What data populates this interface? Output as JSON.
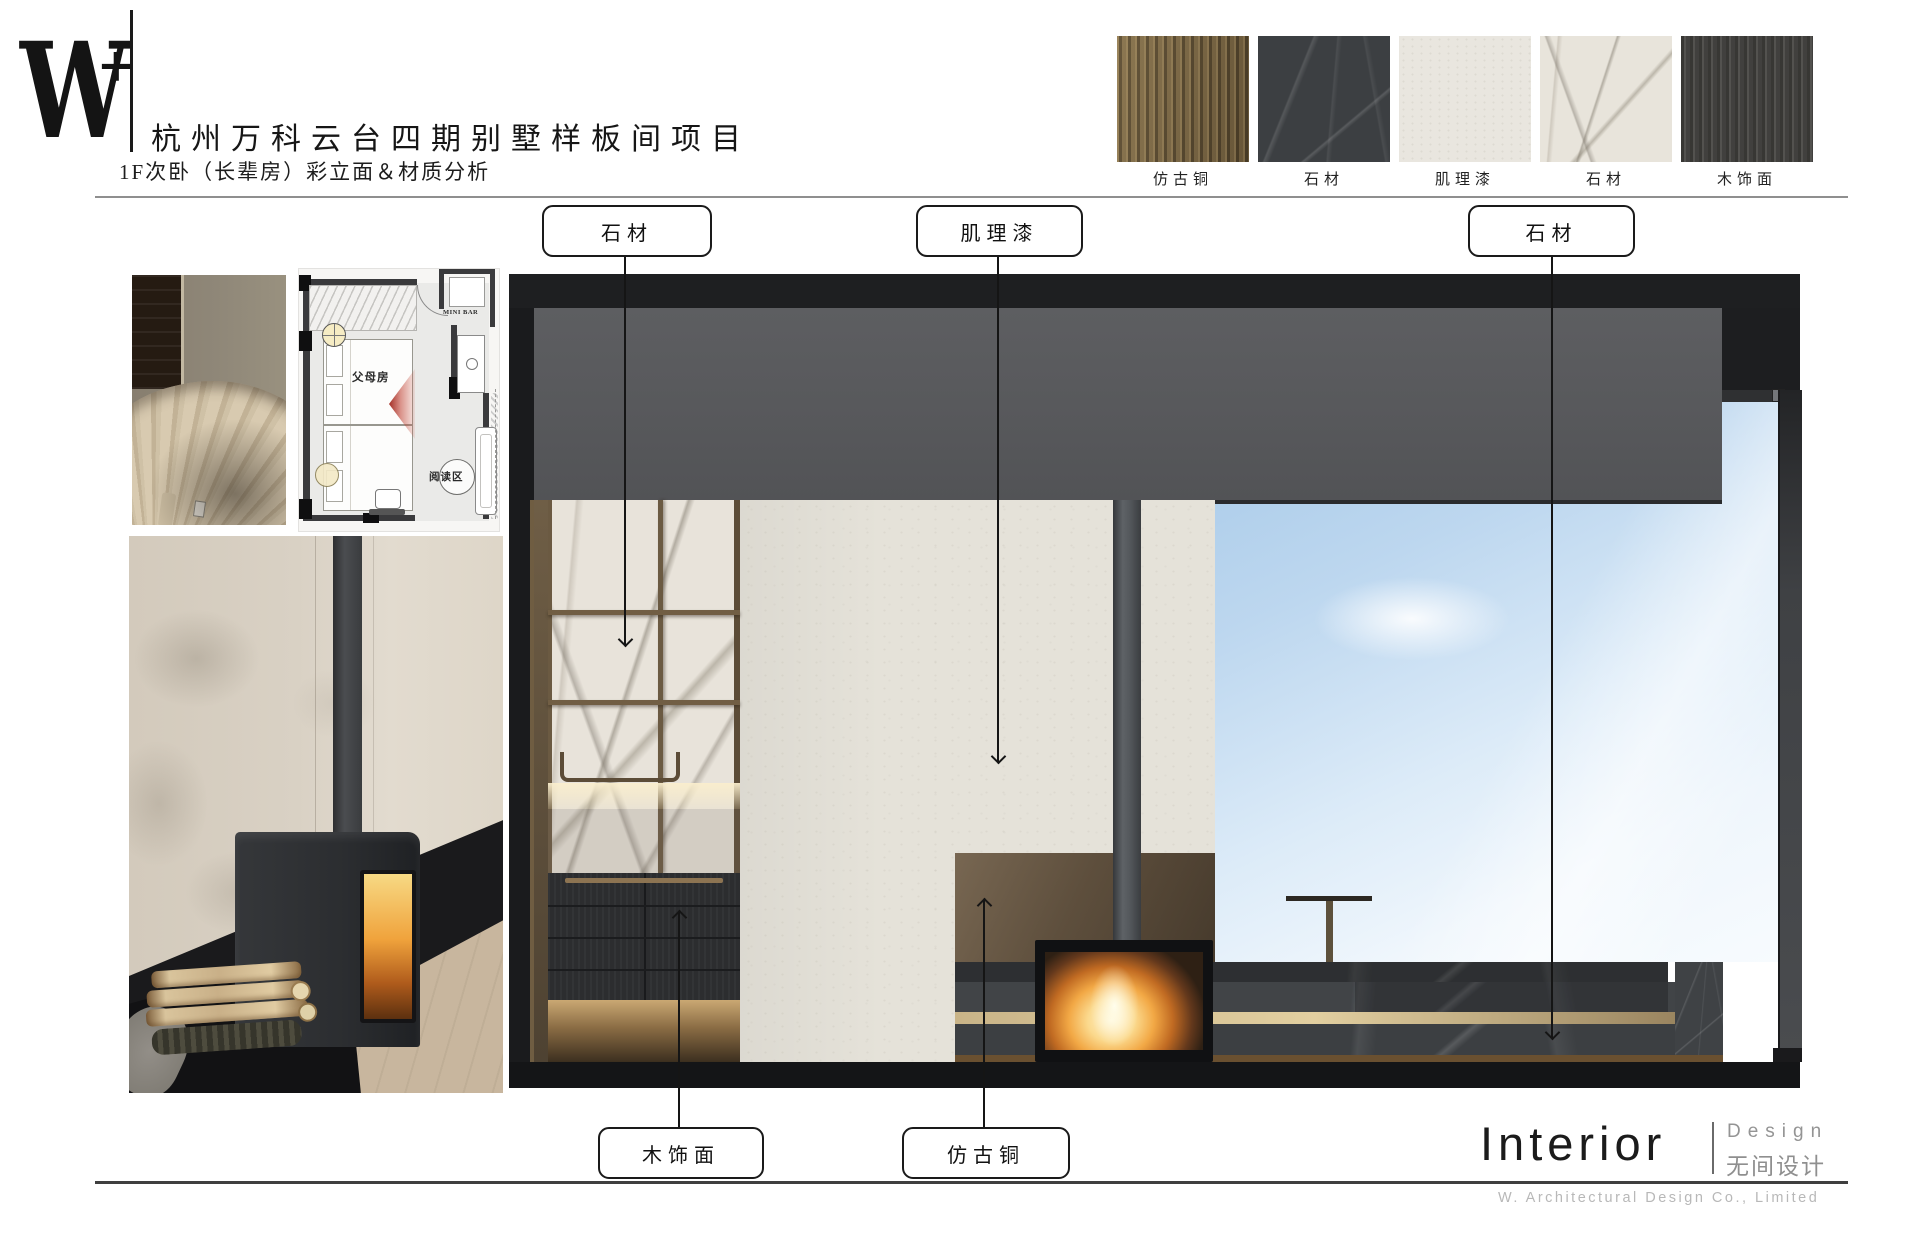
{
  "header": {
    "logo_w": "W",
    "logo_plus": "+",
    "title": "杭州万科云台四期别墅样板间项目",
    "subtitle": "1F次卧（长辈房）彩立面＆材质分析"
  },
  "materials": {
    "items": [
      {
        "label": "仿古铜"
      },
      {
        "label": "石材"
      },
      {
        "label": "肌理漆"
      },
      {
        "label": "石材"
      },
      {
        "label": "木饰面"
      }
    ]
  },
  "callouts": {
    "top": [
      {
        "label": "石材"
      },
      {
        "label": "肌理漆"
      },
      {
        "label": "石材"
      }
    ],
    "bottom": [
      {
        "label": "木饰面"
      },
      {
        "label": "仿古铜"
      }
    ]
  },
  "floor_plan": {
    "room": "父母房",
    "minibar": "MINI BAR",
    "reading": "阅读区"
  },
  "footer": {
    "brand_en": "Interior",
    "design_en": "Design",
    "design_cn": "无间设计",
    "company": "W. Architectural Design Co., Limited"
  },
  "palette": {
    "frame_black": "#1e1f21",
    "beam_gray": "#58595c",
    "texture_paint": "#e5e2d9",
    "sky_blue": "#a6c9e8",
    "antique_bronze": "#6d5939",
    "dark_stone": "#3c3f42",
    "white_marble": "#e8e3da",
    "dark_wood": "#2d2e30",
    "fire_orange": "#f2a845",
    "view_cone_red": "#b73a2c"
  }
}
